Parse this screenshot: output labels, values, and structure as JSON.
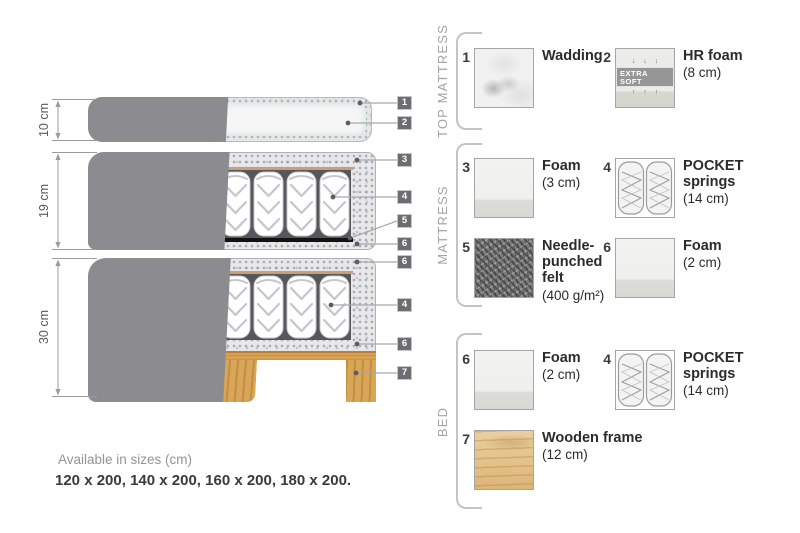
{
  "title": "Mattress construction diagram",
  "diagram": {
    "dimensions": [
      {
        "label": "10 cm"
      },
      {
        "label": "19 cm"
      },
      {
        "label": "30 cm"
      }
    ],
    "tags": [
      {
        "n": "1"
      },
      {
        "n": "2"
      },
      {
        "n": "3"
      },
      {
        "n": "4"
      },
      {
        "n": "5"
      },
      {
        "n": "6"
      },
      {
        "n": "6"
      },
      {
        "n": "4"
      },
      {
        "n": "6"
      },
      {
        "n": "7"
      }
    ],
    "sizes": {
      "title": "Available in sizes (cm)",
      "values": "120 x 200, 140 x 200, 160 x 200, 180 x 200."
    }
  },
  "legend": {
    "sections": [
      {
        "label": "TOP MATTRESS"
      },
      {
        "label": "MATTRESS"
      },
      {
        "label": "BED"
      }
    ],
    "items": [
      {
        "num": "1",
        "name": "Wadding",
        "size": "",
        "swatch": "wadding"
      },
      {
        "num": "2",
        "name": "HR foam",
        "size": "(8 cm)",
        "swatch": "hr-foam",
        "badge": "EXTRA SOFT",
        "arrows_top": "↓ ↓ ↓",
        "arrows_bottom": "↑ ↑ ↑"
      },
      {
        "num": "3",
        "name": "Foam",
        "size": "(3 cm)",
        "swatch": "foam"
      },
      {
        "num": "4",
        "name": "POCKET springs",
        "size": "(14 cm)",
        "swatch": "pocket-springs"
      },
      {
        "num": "5",
        "name": "Needle-punched felt",
        "size": "(400 g/m²)",
        "swatch": "felt"
      },
      {
        "num": "6",
        "name": "Foam",
        "size": "(2 cm)",
        "swatch": "foam"
      },
      {
        "num": "6",
        "name": "Foam",
        "size": "(2 cm)",
        "swatch": "foam"
      },
      {
        "num": "4",
        "name": "POCKET springs",
        "size": "(14 cm)",
        "swatch": "pocket-springs"
      },
      {
        "num": "7",
        "name": "Wooden frame",
        "size": "(12 cm)",
        "swatch": "wood"
      }
    ]
  },
  "colors": {
    "cover_gray": "#8b8b90",
    "foam_speckle": "#e8e8eb",
    "spring_gap": "#56565c",
    "felt_black": "#121212",
    "wood": "#d9a557",
    "tan_line": "#c7a173",
    "tag_bg": "#6c6c71",
    "text_dark": "#2b2b2b",
    "text_gray": "#949494"
  }
}
